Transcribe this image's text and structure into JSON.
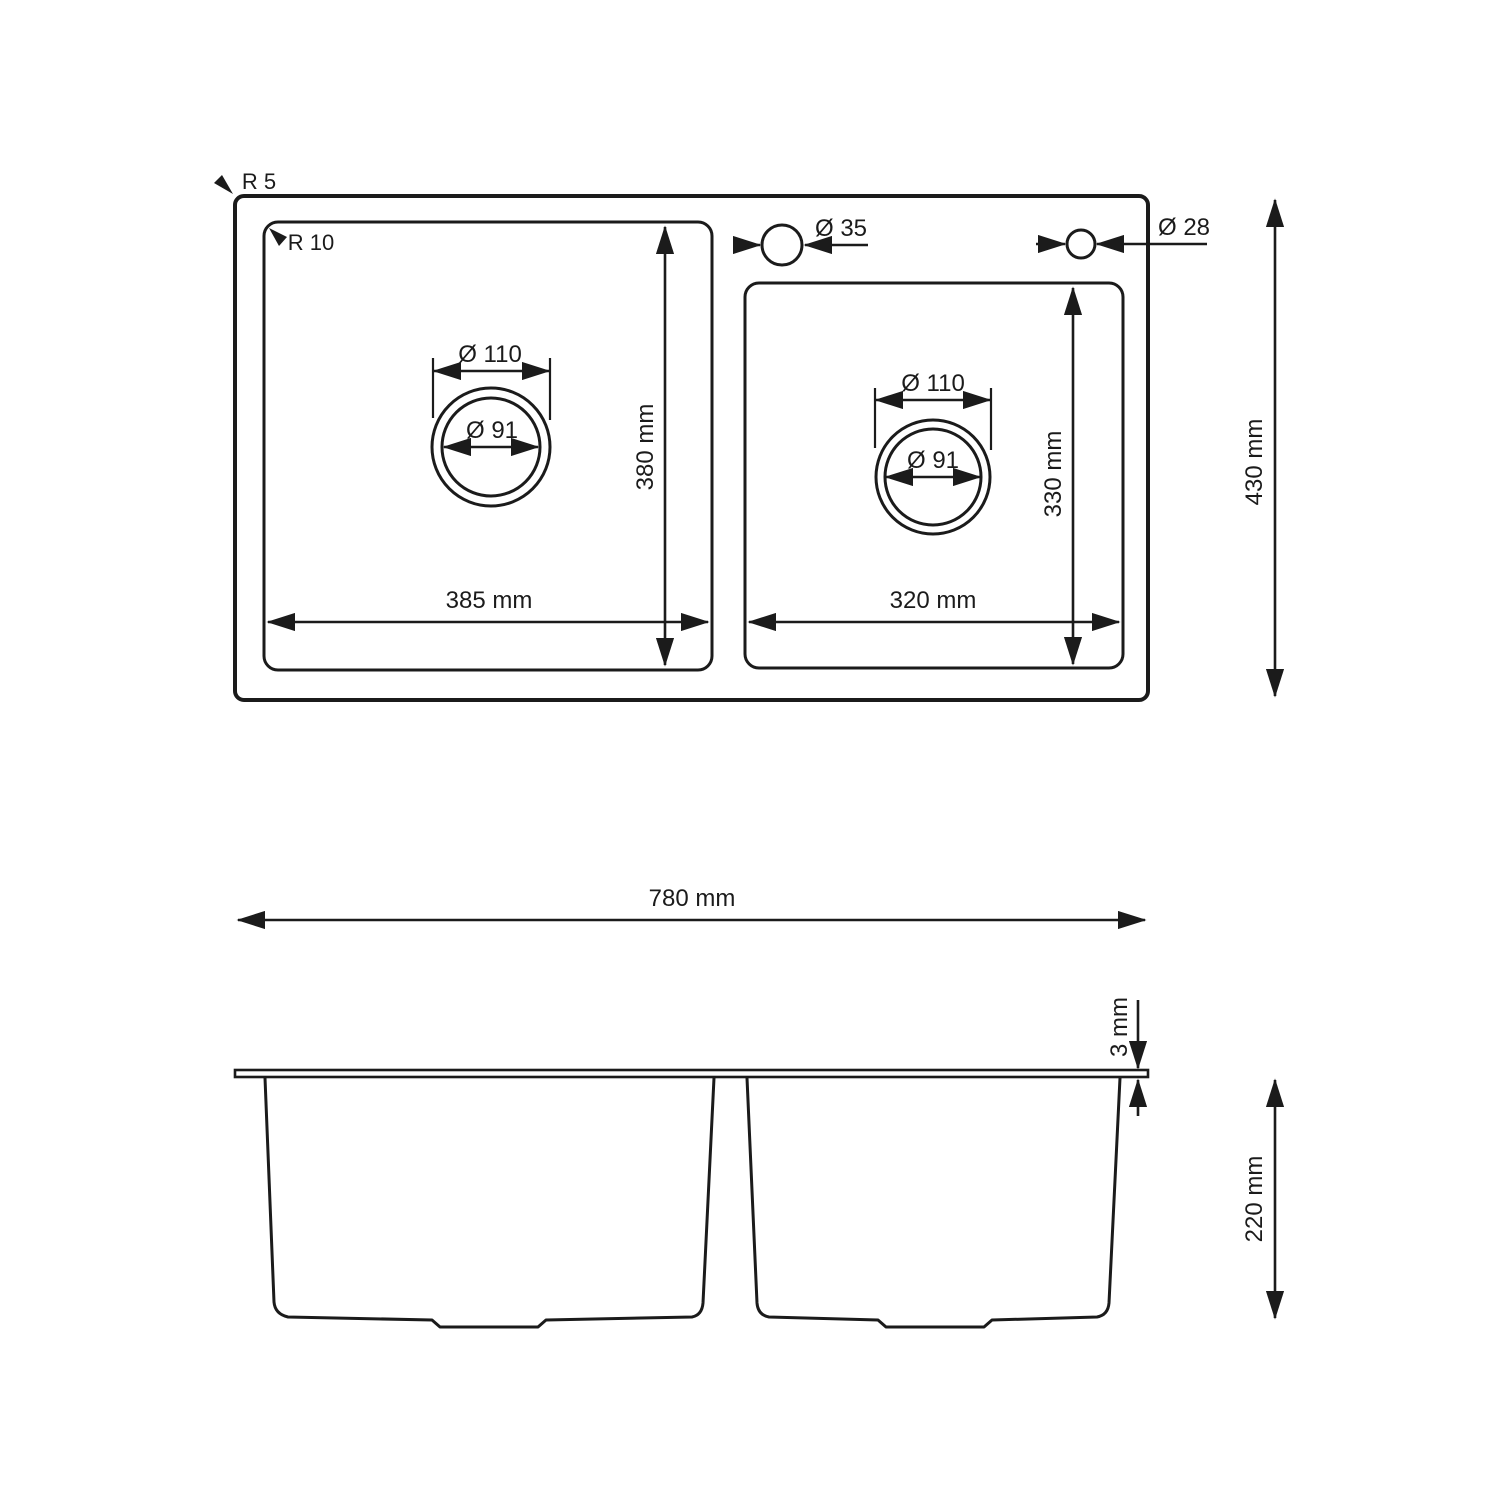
{
  "colors": {
    "line": "#1b1b1b",
    "background": "#ffffff"
  },
  "top_view": {
    "outer_corner_radius_label": "R 5",
    "inner_corner_radius_label": "R 10",
    "faucet_hole_main_label": "Ø 35",
    "faucet_hole_secondary_label": "Ø 28",
    "overall_depth_label": "430 mm",
    "left_bowl": {
      "drain_outer_label": "Ø 110",
      "drain_inner_label": "Ø 91",
      "width_label": "385 mm",
      "depth_label": "380 mm"
    },
    "right_bowl": {
      "drain_outer_label": "Ø 110",
      "drain_inner_label": "Ø 91",
      "width_label": "320 mm",
      "depth_label": "330 mm"
    }
  },
  "section_view": {
    "overall_width_label": "780 mm",
    "rim_thickness_label": "3 mm",
    "bowl_height_label": "220 mm"
  }
}
